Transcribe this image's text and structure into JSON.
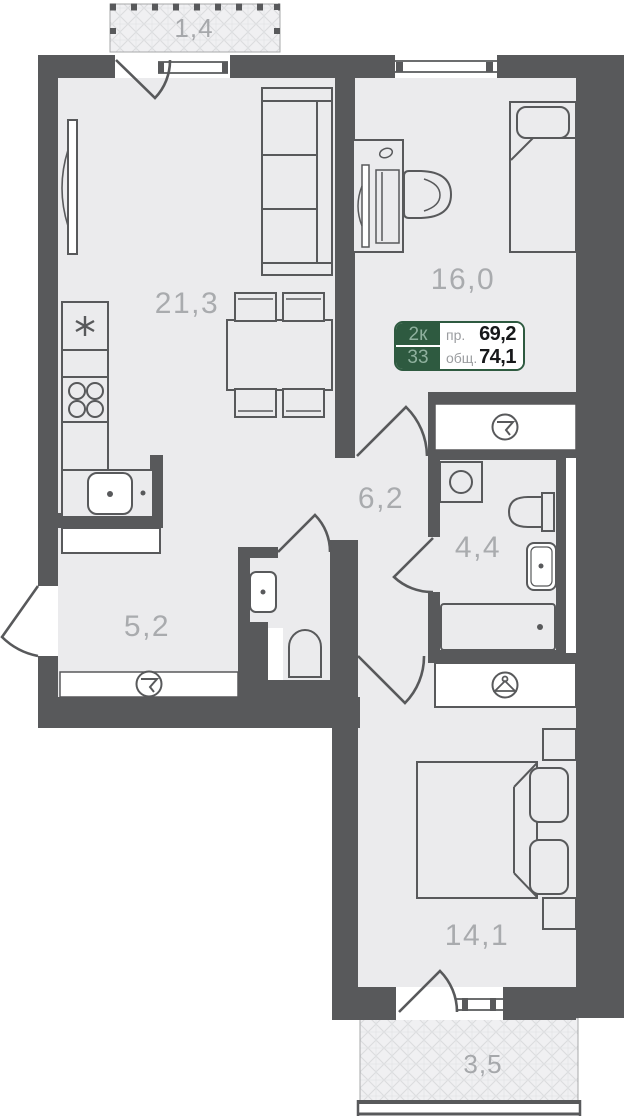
{
  "plan": {
    "card": {
      "rooms_count": "2к",
      "unit_number": "33",
      "living_label": "пр.",
      "living_value": "69,2",
      "total_label": "общ.",
      "total_value": "74,1"
    },
    "rooms": [
      {
        "name": "living-kitchen",
        "area": "21,3"
      },
      {
        "name": "bedroom-1",
        "area": "16,0"
      },
      {
        "name": "hallway",
        "area": "6,2"
      },
      {
        "name": "bathroom",
        "area": "4,4"
      },
      {
        "name": "corridor",
        "area": "5,2"
      },
      {
        "name": "bedroom-2",
        "area": "14,1"
      },
      {
        "name": "balcony-top",
        "area": "1,4"
      },
      {
        "name": "balcony-bottom",
        "area": "3,5"
      }
    ],
    "colors": {
      "wall": "#58595b",
      "floor": "#ebebed",
      "accent_green": "#2e5a40",
      "label_text": "#a9abae"
    }
  }
}
